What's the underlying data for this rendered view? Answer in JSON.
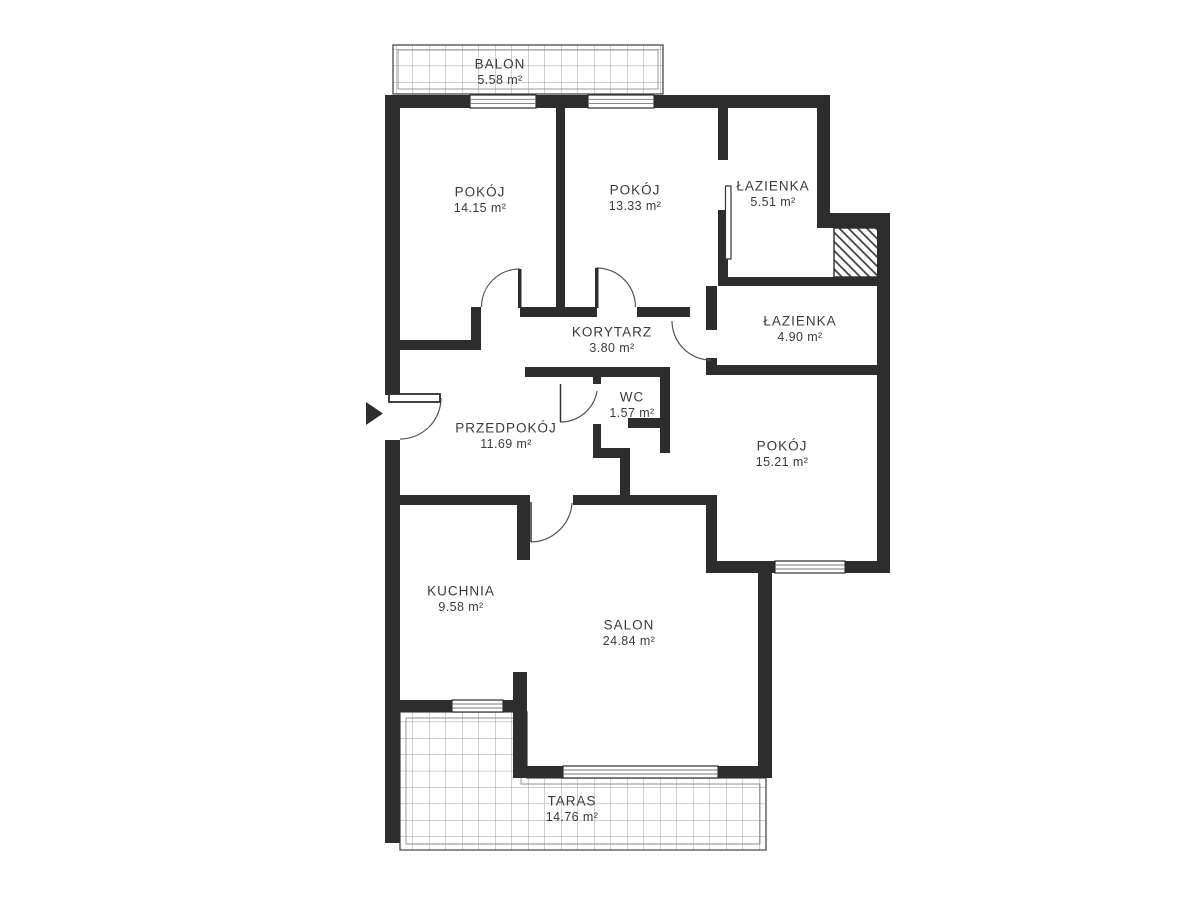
{
  "plan": {
    "type": "apartment-floor-plan",
    "colors": {
      "wall": "#2d2d2d",
      "text": "#3b3b3b",
      "grid": "#a0a0a0",
      "door_arc": "#555555",
      "background": "#ffffff"
    },
    "rooms": [
      {
        "id": "balon",
        "name": "BALON",
        "area": "5.58 m²",
        "cx": 500,
        "cy": 64
      },
      {
        "id": "pokoj-1",
        "name": "POKÓJ",
        "area": "14.15 m²",
        "cx": 480,
        "cy": 192
      },
      {
        "id": "pokoj-2",
        "name": "POKÓJ",
        "area": "13.33 m²",
        "cx": 635,
        "cy": 190
      },
      {
        "id": "lazienka-1",
        "name": "ŁAZIENKA",
        "area": "5.51 m²",
        "cx": 773,
        "cy": 186
      },
      {
        "id": "lazienka-2",
        "name": "ŁAZIENKA",
        "area": "4.90 m²",
        "cx": 800,
        "cy": 321
      },
      {
        "id": "korytarz",
        "name": "KORYTARZ",
        "area": "3.80 m²",
        "cx": 612,
        "cy": 332
      },
      {
        "id": "wc",
        "name": "WC",
        "area": "1.57 m²",
        "cx": 632,
        "cy": 397
      },
      {
        "id": "przedpokoj",
        "name": "PRZEDPOKÓJ",
        "area": "11.69 m²",
        "cx": 506,
        "cy": 428
      },
      {
        "id": "pokoj-3",
        "name": "POKÓJ",
        "area": "15.21 m²",
        "cx": 782,
        "cy": 446
      },
      {
        "id": "kuchnia",
        "name": "KUCHNIA",
        "area": "9.58 m²",
        "cx": 461,
        "cy": 591
      },
      {
        "id": "salon",
        "name": "SALON",
        "area": "24.84 m²",
        "cx": 629,
        "cy": 625
      },
      {
        "id": "taras",
        "name": "TARAS",
        "area": "14.76 m²",
        "cx": 572,
        "cy": 801
      }
    ],
    "entrance": {
      "marker": "arrow-right",
      "x": 366,
      "y": 402
    }
  }
}
